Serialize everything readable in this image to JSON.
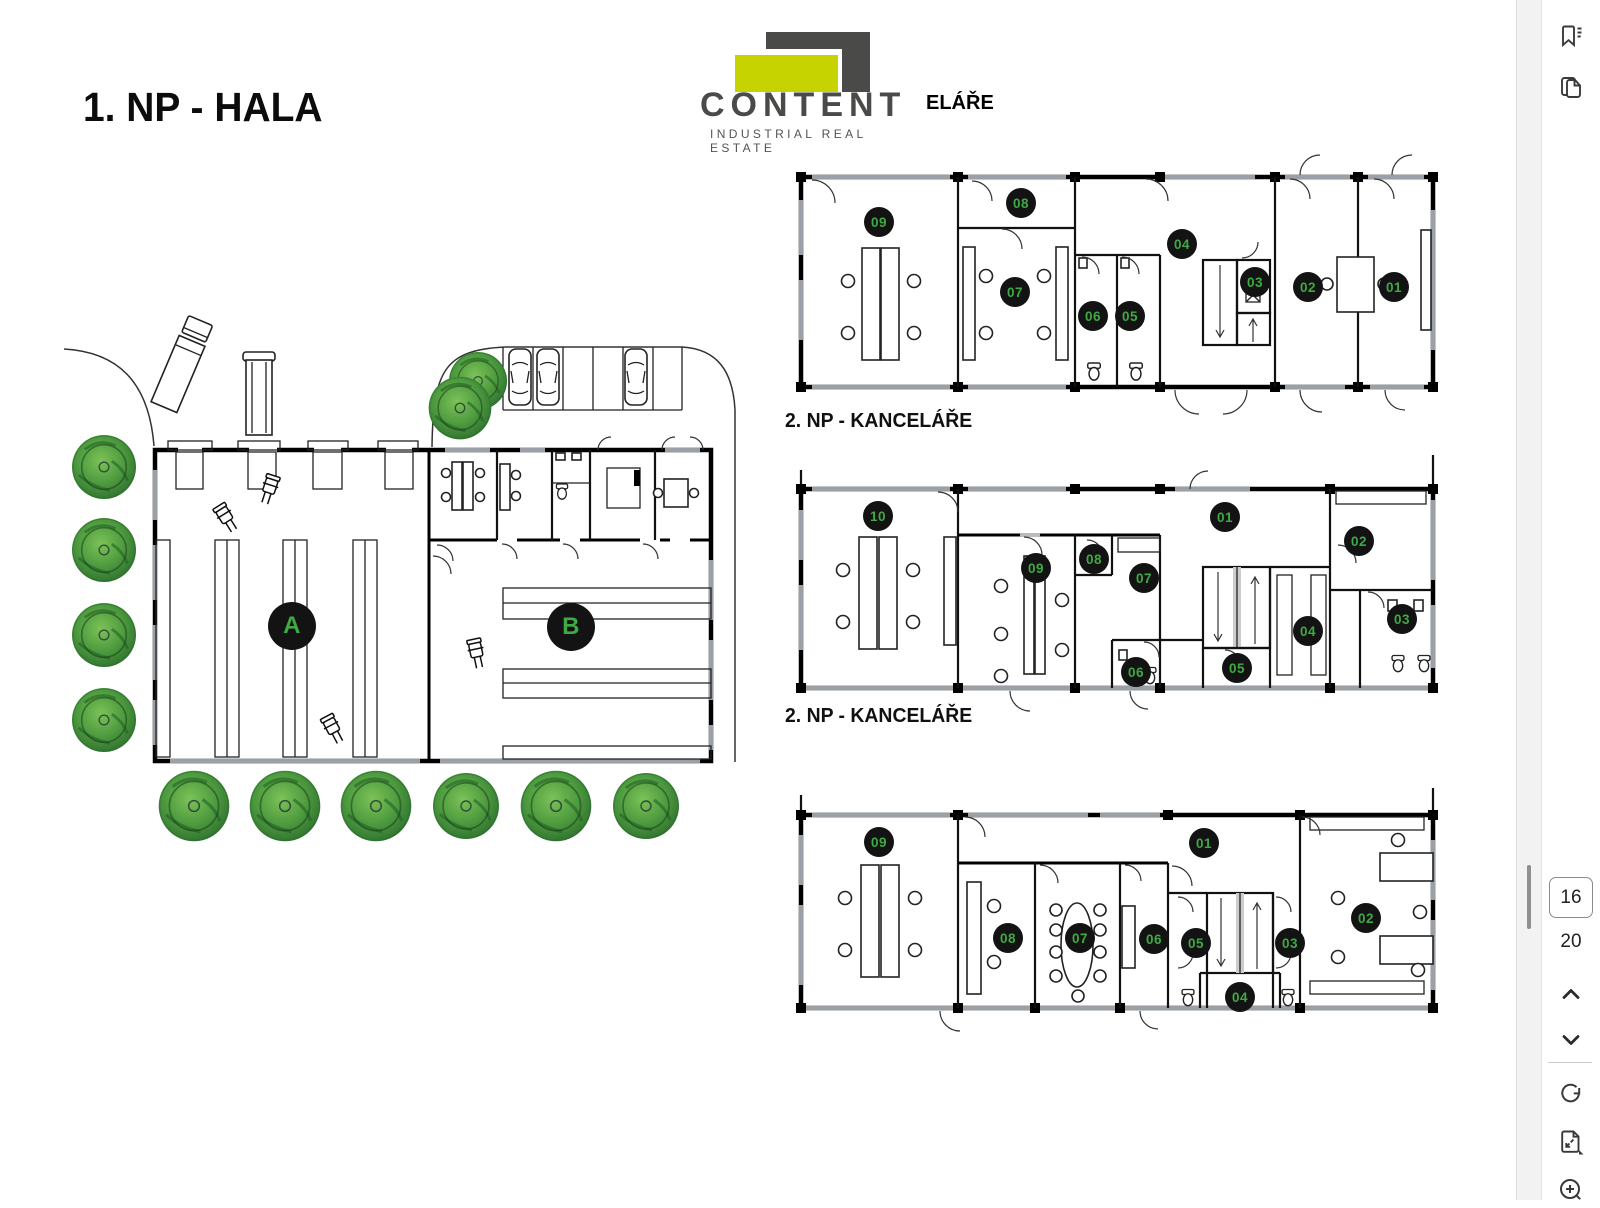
{
  "header": {
    "title": "1. NP - HALA",
    "plan1_label_fragment": "ELÁŘE"
  },
  "logo": {
    "name": "CONTENT",
    "tagline": "INDUSTRIAL REAL ESTATE",
    "lime_color": "#c6d300",
    "dark_color": "#4a4a48"
  },
  "plans": {
    "hall": {
      "sections": [
        "A",
        "B"
      ]
    },
    "plan1": {
      "rooms": [
        "09",
        "08",
        "07",
        "06",
        "05",
        "04",
        "03",
        "02",
        "01"
      ]
    },
    "plan2": {
      "label": "2. NP - KANCELÁŘE",
      "rooms": [
        "10",
        "09",
        "08",
        "07",
        "06",
        "05",
        "04",
        "03",
        "02",
        "01"
      ]
    },
    "plan3": {
      "label": "2. NP - KANCELÁŘE",
      "rooms": [
        "09",
        "08",
        "07",
        "06",
        "05",
        "04",
        "03",
        "02",
        "01"
      ]
    }
  },
  "badge_style": {
    "background": "#131313",
    "text_color": "#3fa944"
  },
  "viewer": {
    "current_page": "16",
    "total_pages": "20",
    "icons": {
      "top": [
        "bookmarks-icon",
        "page-thumbnails-icon"
      ],
      "bottom": [
        "page-up-icon",
        "page-down-icon",
        "rotate-icon",
        "fit-to-page-icon",
        "zoom-in-icon"
      ]
    }
  }
}
